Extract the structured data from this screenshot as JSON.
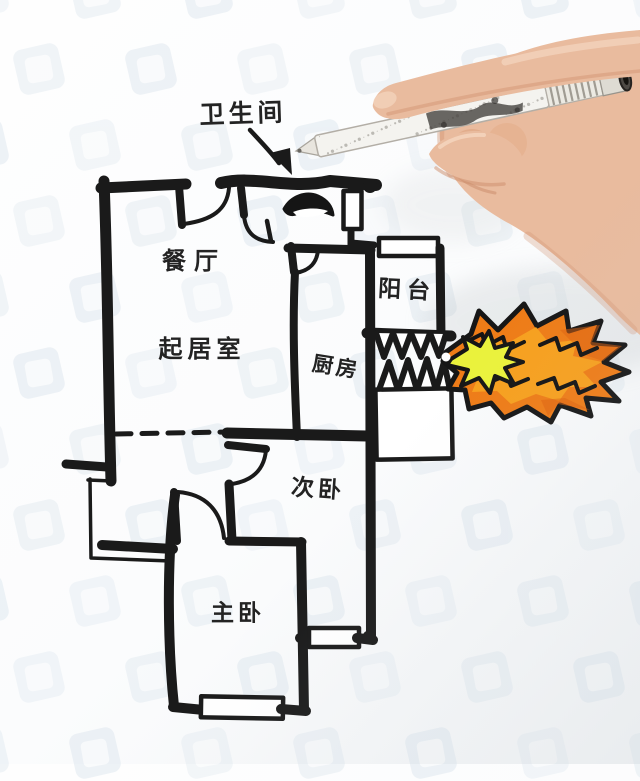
{
  "labels": {
    "bathroom_callout": "卫生间",
    "dining_room": "餐厅",
    "living_room": "起居室",
    "balcony": "阳台",
    "kitchen": "厨房",
    "second_bedroom": "次卧",
    "master_bedroom": "主卧"
  },
  "colors": {
    "wall_ink": "#1a1a1a",
    "flame_outer": "#ee7c17",
    "flame_mid": "#f7a41f",
    "flame_deep": "#dd5f0e",
    "flame_core": "#eaf23c",
    "skin": "#e9bb9e",
    "pen_body": "#f4f3ef",
    "watermark": "#dce6ee"
  }
}
